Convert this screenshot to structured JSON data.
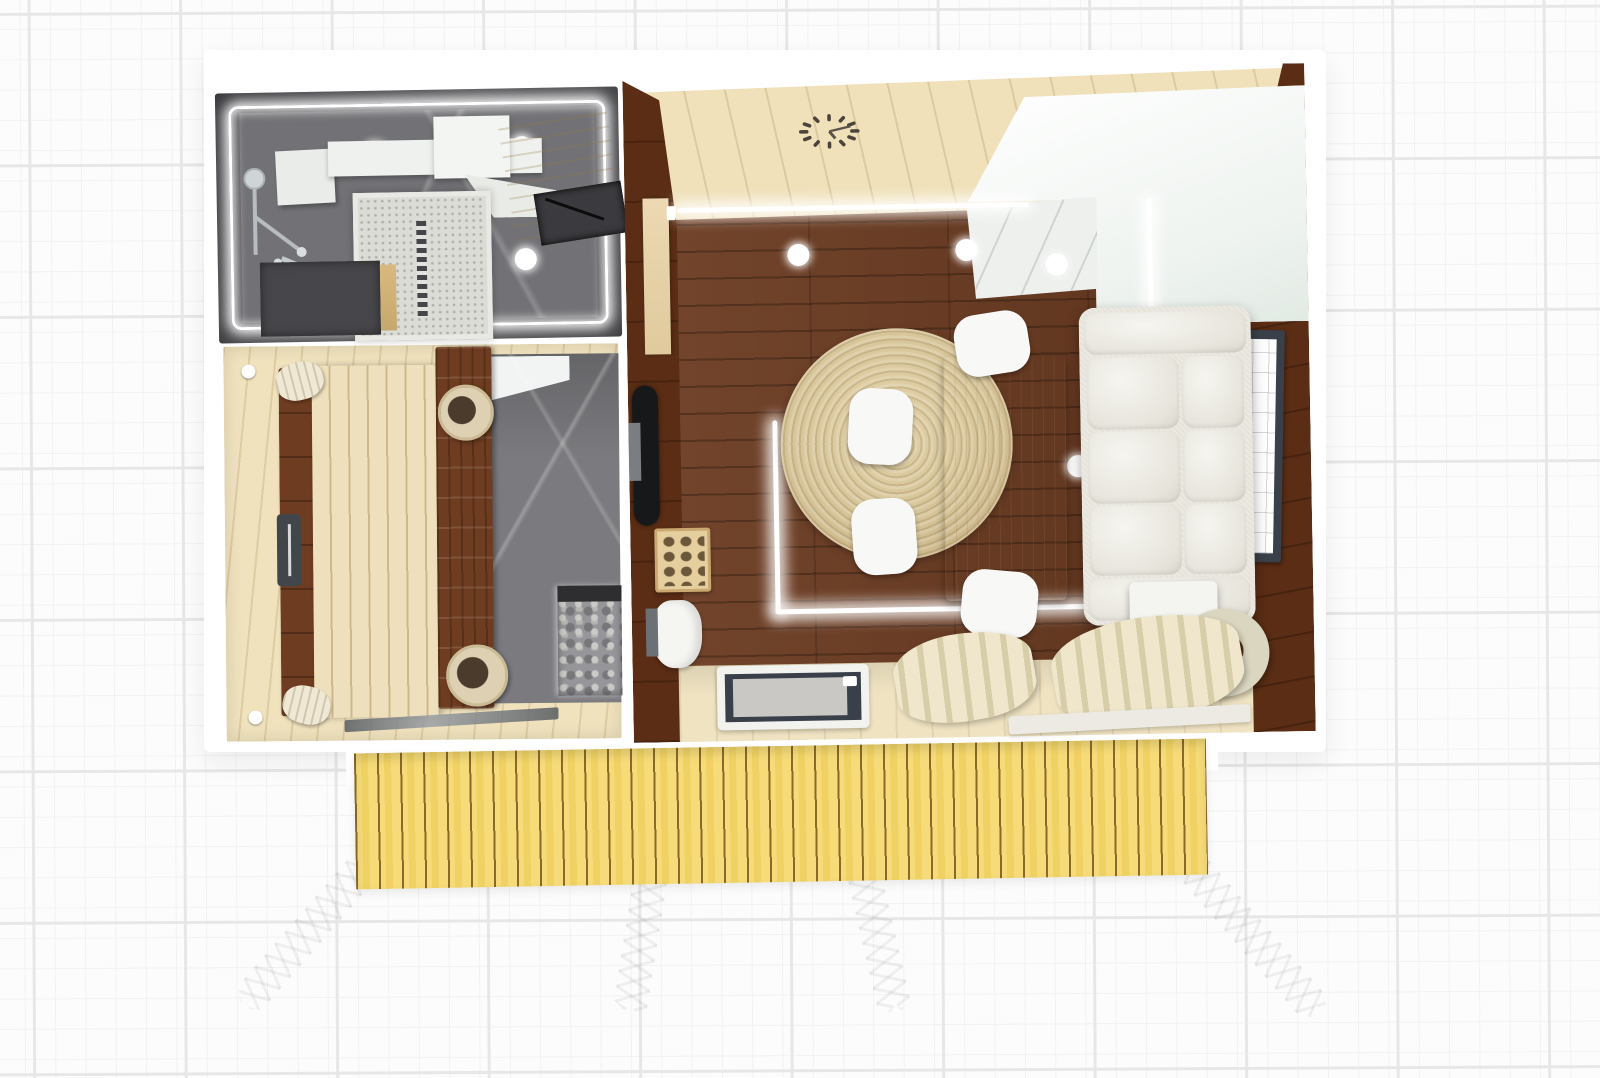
{
  "app": {
    "view": "3d-floorplan-top-down",
    "description": "Rendered top-down 3D floor plan of a small cabin: bathroom, sauna, living room with kitchenette, and a front deck with four stair stringers, on a light blueprint grid"
  },
  "canvas": {
    "width": 1600,
    "height": 1078
  },
  "colors": {
    "bg": "#fcfcfc",
    "grid_minor": "#f2f2f2",
    "grid_major": "#e7e7e7",
    "bath_wall": "#57575b",
    "bath_floor": "#727276",
    "counter_white": "#eef1ee",
    "mosaic": "#dcdcd6",
    "marble": "#7b7b7f",
    "wood_cream": "#f0e2bd",
    "wood_gap": "#cdb88c",
    "sauna_bench_dark": "#6e3c20",
    "heater_stone": "#96969a",
    "living_floor": "#6a3a20",
    "wall_brown": "#5a2d14",
    "ceiling_wood": "#f0e1ba",
    "kitchen_white": "#eef3ef",
    "rug": "#d6c498",
    "table": "#ecd9ae",
    "chair": "#f8f8f6",
    "sofa": "#ebe9e1",
    "window_frame": "#3a4049",
    "glass_grey": "#c9c8c4",
    "curtain": "#efe6cb",
    "stove_black": "#17181a",
    "deck": "#f6db78",
    "deck_gap": "#8a6a2a",
    "stringer": "#dddcd7",
    "led": "#ffffff"
  },
  "building": {
    "rooms": [
      {
        "id": "bathroom",
        "items": [
          "perimeter-led-strip",
          "ceiling-spotlight x4",
          "shower-set",
          "shower-shelf",
          "vanity-counter",
          "wood-counter",
          "towel-slot-shelf",
          "mosaic-shower-tray",
          "linear-drain",
          "storage-cabinet"
        ]
      },
      {
        "id": "sauna",
        "items": [
          "upper-bench",
          "backrest-left",
          "backrest-right",
          "headrest x2",
          "corner-knob x2",
          "wooden-bucket x2",
          "door-handle",
          "stone-heater",
          "glass-door"
        ]
      },
      {
        "id": "living-room",
        "items": [
          "plank-ceiling",
          "wall-clock",
          "kitchenette-L-counter",
          "sink",
          "led-strip x4",
          "ceiling-spotlight x4",
          "round-jute-rug",
          "dining-table",
          "dining-chair x4",
          "three-seat-sofa",
          "side-window",
          "bottom-window x2",
          "curtains x2",
          "pelmet-shelf",
          "ring-floor-lamp",
          "side-table",
          "entry-glass-door",
          "wall-stove",
          "stove-panel",
          "firewood-crate",
          "door-panel",
          "appliance"
        ]
      },
      {
        "id": "deck",
        "items": [
          "yellow-plank-decking",
          "stair-stringer x4"
        ]
      }
    ]
  }
}
